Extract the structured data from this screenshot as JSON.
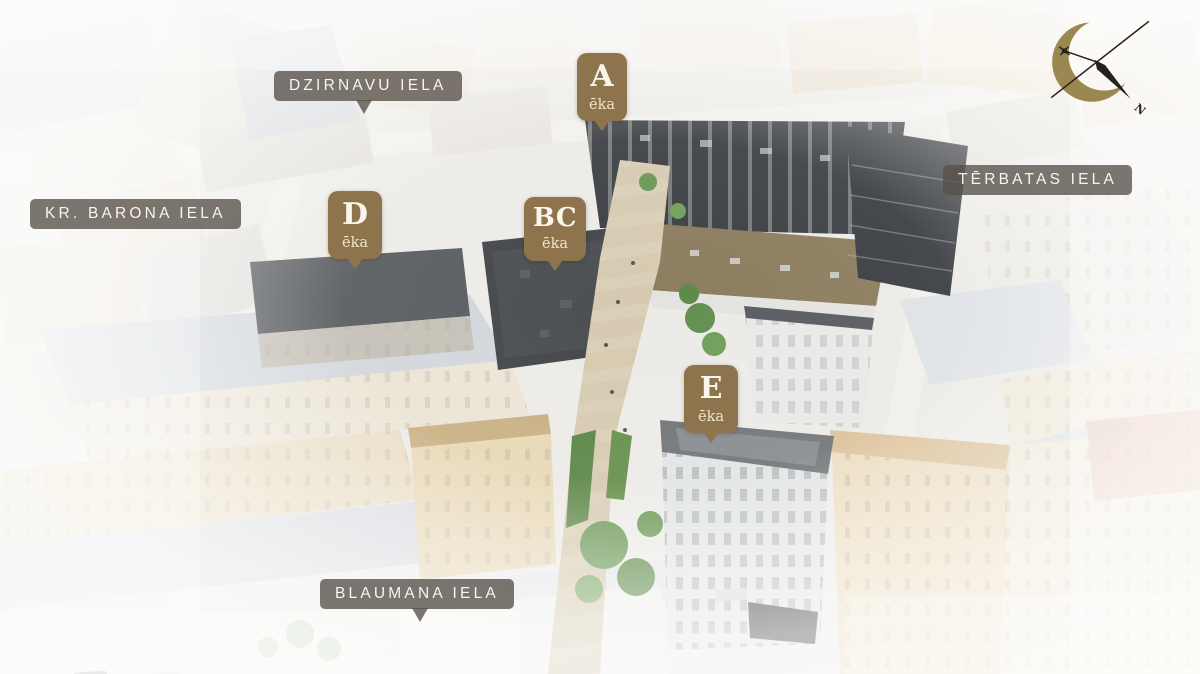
{
  "street_labels": [
    {
      "name": "dzirnavu",
      "text": "DZIRNAVU IELA"
    },
    {
      "name": "kr_barona",
      "text": "KR. BARONA IELA"
    },
    {
      "name": "terbatas",
      "text": "TĒRBATAS IELA"
    },
    {
      "name": "blaumana",
      "text": "BLAUMANA IELA"
    }
  ],
  "building_markers": [
    {
      "letter": "A",
      "sublabel": "ēka"
    },
    {
      "letter": "D",
      "sublabel": "ēka"
    },
    {
      "letter": "BC",
      "sublabel": "ēka"
    },
    {
      "letter": "E",
      "sublabel": "ēka"
    }
  ],
  "compass": {
    "north_label": "N"
  },
  "colors": {
    "marker_bg": "#8e744c",
    "marker_text": "#faf6ec",
    "marker_subtext": "#efe4c8",
    "street_label_bg": "rgba(86,80,72,0.78)",
    "street_label_text": "#f6f5f3",
    "compass_gold": "#9a8850",
    "compass_dark": "#26221b"
  }
}
